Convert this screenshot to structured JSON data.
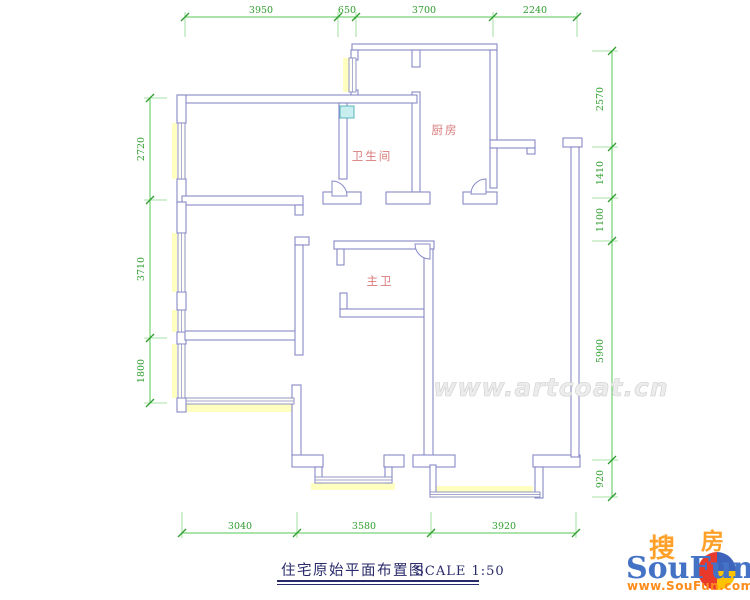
{
  "title": {
    "text": "住宅原始平面布置图",
    "scale": "SCALE 1:50"
  },
  "rooms": {
    "bathroom": "卫生间",
    "kitchen": "厨房",
    "master_bath": "主卫"
  },
  "dimensions": {
    "top": [
      "3950",
      "650",
      "3700",
      "2240"
    ],
    "bottom": [
      "3040",
      "3580",
      "3920"
    ],
    "left": [
      "2720",
      "3710",
      "1800"
    ],
    "right": [
      "2570",
      "1410",
      "1100",
      "5900",
      "920"
    ]
  },
  "watermark": {
    "text": "www.artcoat.cn"
  },
  "logo": {
    "cn_sou": "搜",
    "cn_fang": "房",
    "wordmark": "SouFun",
    "site": "www.SouFun.com"
  },
  "colors": {
    "wall_line": "#8789c5",
    "dimension_green": "#2f9e2f",
    "room_label_red": "#d97b7b",
    "window_band_yellow": "#ffffc0",
    "title_navy": "#2a2a6a",
    "logo_blue": "#4473c5",
    "logo_orange": "#ff9d2e",
    "highlight_teal": "#c8eef0"
  }
}
